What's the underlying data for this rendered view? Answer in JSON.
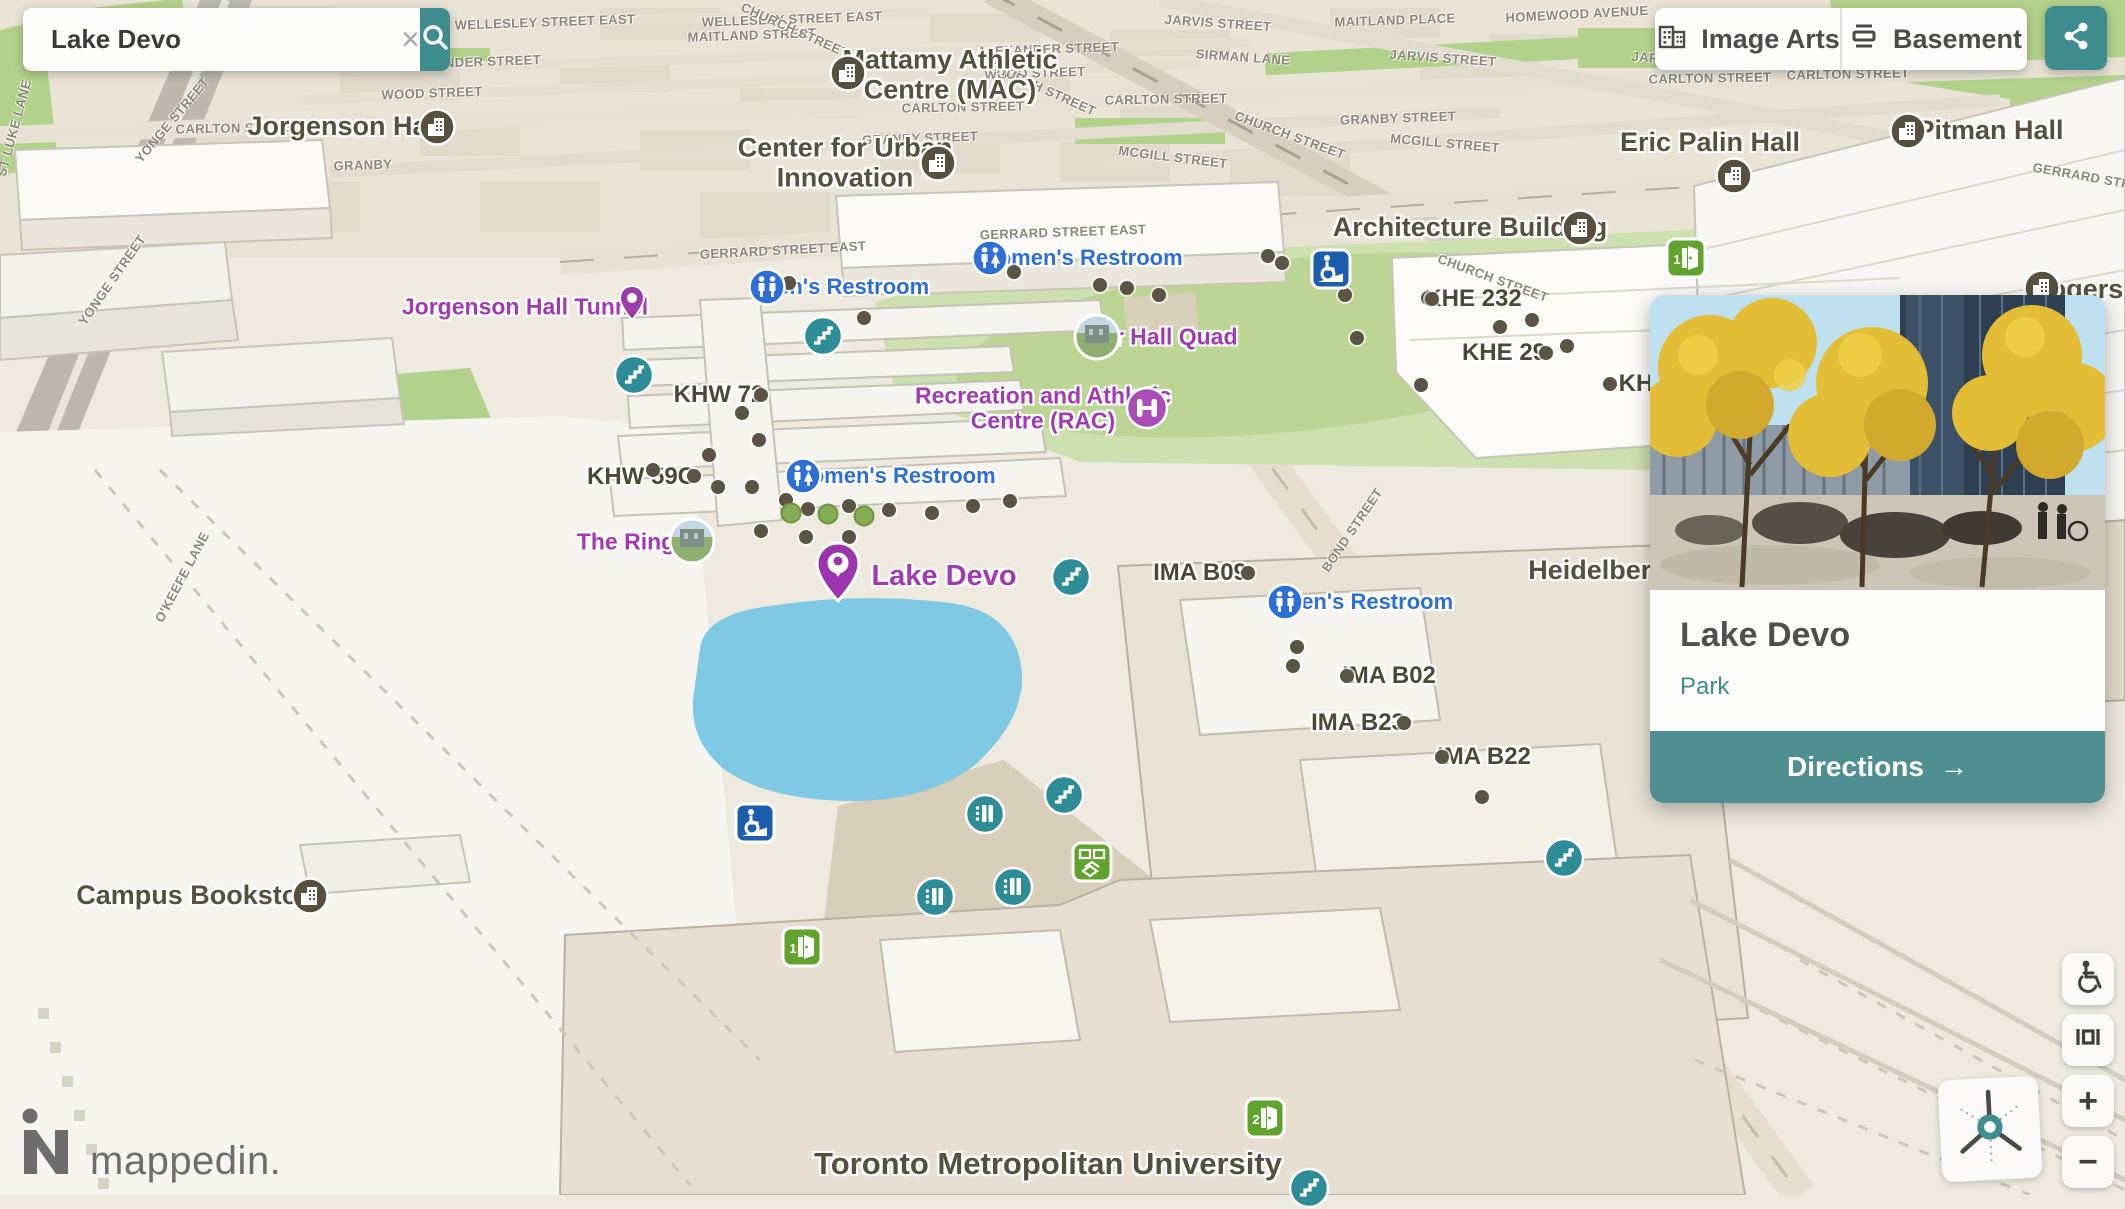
{
  "theme": {
    "accent_teal": "#3f8c8e",
    "purple": "#a23ab2",
    "label_blue": "#2e6fd6",
    "label_olive": "#57503e",
    "quad_green": "#c6dca6",
    "lake_blue": "#7fc9e4",
    "door_green": "#61a32d",
    "ramp_blue": "#1d5dad"
  },
  "search": {
    "value": "Lake Devo",
    "placeholder": "Search",
    "clear_icon": "×"
  },
  "toolbar": {
    "image_arts_label": "Image Arts",
    "basement_label": "Basement"
  },
  "card": {
    "title": "Lake Devo",
    "category": "Park",
    "directions_label": "Directions",
    "directions_arrow": "→"
  },
  "logo": {
    "text": "mappedin."
  },
  "controls": {
    "zoom_in": "+",
    "zoom_out": "−"
  },
  "map": {
    "streets": [
      {
        "t": "WELLESLEY STREET EAST",
        "x": 545,
        "y": 22,
        "r": -2
      },
      {
        "t": "WELLESLEY STREET EAST",
        "x": 792,
        "y": 19,
        "r": -2
      },
      {
        "t": "MAITLAND PLACE",
        "x": 1395,
        "y": 20,
        "r": -2
      },
      {
        "t": "HOMEWOOD AVENUE",
        "x": 1577,
        "y": 14,
        "r": -3
      },
      {
        "t": "JARVIS STREET",
        "x": 1218,
        "y": 23,
        "r": 4
      },
      {
        "t": "JARVIS STREET",
        "x": 1443,
        "y": 58,
        "r": 4
      },
      {
        "t": "JARVIS STREET",
        "x": 1685,
        "y": 60,
        "r": 4
      },
      {
        "t": "MAITLAND STREET",
        "x": 752,
        "y": 35,
        "r": -2
      },
      {
        "t": "ALEXANDER STREET",
        "x": 470,
        "y": 62,
        "r": -2
      },
      {
        "t": "ALEXANDER STREET",
        "x": 1048,
        "y": 49,
        "r": -2
      },
      {
        "t": "WOOD STREET",
        "x": 432,
        "y": 93,
        "r": -2
      },
      {
        "t": "WOOD STREET",
        "x": 1035,
        "y": 73,
        "r": -2
      },
      {
        "t": "SIRMAN LANE",
        "x": 1243,
        "y": 57,
        "r": 4
      },
      {
        "t": "CARLTON STREET",
        "x": 237,
        "y": 128,
        "r": -1
      },
      {
        "t": "CARLTON STREET",
        "x": 963,
        "y": 107,
        "r": -1
      },
      {
        "t": "CARLTON STREET",
        "x": 1166,
        "y": 99,
        "r": -1
      },
      {
        "t": "CARLTON STREET",
        "x": 1710,
        "y": 78,
        "r": -1
      },
      {
        "t": "CARLTON STREET",
        "x": 1848,
        "y": 74,
        "r": -1
      },
      {
        "t": "CHURCH STREET",
        "x": 795,
        "y": 30,
        "r": 24
      },
      {
        "t": "CHURCH STREET",
        "x": 1042,
        "y": 88,
        "r": 24
      },
      {
        "t": "CHURCH STREET",
        "x": 1290,
        "y": 135,
        "r": 20
      },
      {
        "t": "CHURCH STREET",
        "x": 1493,
        "y": 278,
        "r": 20
      },
      {
        "t": "MCGILL STREET",
        "x": 1173,
        "y": 157,
        "r": 7
      },
      {
        "t": "MCGILL STREET",
        "x": 1445,
        "y": 143,
        "r": 5
      },
      {
        "t": "GRANBY STREET",
        "x": 920,
        "y": 138,
        "r": -2
      },
      {
        "t": "GRANBY",
        "x": 363,
        "y": 165,
        "r": -2
      },
      {
        "t": "GRANBY STREET",
        "x": 1398,
        "y": 118,
        "r": -2
      },
      {
        "t": "GERRARD STREET EAST",
        "x": 783,
        "y": 250,
        "r": -3
      },
      {
        "t": "GERRARD STREET EAST",
        "x": 1063,
        "y": 232,
        "r": -2
      },
      {
        "t": "GERRARD STREET",
        "x": 2095,
        "y": 178,
        "r": 10
      },
      {
        "t": "BOND STREET",
        "x": 1352,
        "y": 530,
        "r": -56
      },
      {
        "t": "YONGE STREET",
        "x": 172,
        "y": 120,
        "r": -50
      },
      {
        "t": "YONGE STREET",
        "x": 112,
        "y": 280,
        "r": -55
      },
      {
        "t": "ST LUKE LANE",
        "x": 14,
        "y": 128,
        "r": -75
      },
      {
        "t": "O'KEEFE LANE",
        "x": 182,
        "y": 577,
        "r": -62
      }
    ],
    "buildings": [
      {
        "lines": [
          "Mattamy Athletic",
          "Centre (MAC)"
        ],
        "x": 950,
        "y": 75
      },
      {
        "lines": [
          "Center for Urban",
          "Innovation"
        ],
        "x": 845,
        "y": 163
      },
      {
        "lines": [
          "Jorgenson Hall"
        ],
        "x": 345,
        "y": 127
      },
      {
        "lines": [
          "Eric Palin Hall"
        ],
        "x": 1710,
        "y": 143
      },
      {
        "lines": [
          "Pitman Hall"
        ],
        "x": 1990,
        "y": 131
      },
      {
        "lines": [
          "Architecture Building"
        ],
        "x": 1470,
        "y": 228
      },
      {
        "lines": [
          "Campus Bookstore"
        ],
        "x": 200,
        "y": 896
      },
      {
        "lines": [
          "Rogers Communications"
        ],
        "x": 2190,
        "y": 290
      },
      {
        "lines": [
          "Heidelberg"
        ],
        "x": 1598,
        "y": 571
      },
      {
        "lines": [
          "Toronto Metropolitan University"
        ],
        "x": 1048,
        "y": 1164,
        "size": 31,
        "tmu": true
      }
    ],
    "rooms": [
      {
        "t": "KHW 72",
        "x": 719,
        "y": 395
      },
      {
        "t": "KHW 59C",
        "x": 641,
        "y": 477
      },
      {
        "t": "KHE 232",
        "x": 1473,
        "y": 299
      },
      {
        "t": "KHE 29",
        "x": 1504,
        "y": 353
      },
      {
        "t": "KH",
        "x": 1636,
        "y": 384
      },
      {
        "t": "IMA B09",
        "x": 1200,
        "y": 573
      },
      {
        "t": "IMA B02",
        "x": 1389,
        "y": 676
      },
      {
        "t": "IMA B23",
        "x": 1358,
        "y": 723
      },
      {
        "t": "IMA B22",
        "x": 1484,
        "y": 757
      }
    ],
    "purple_labels": [
      {
        "lines": [
          "Jorgenson Hall Tunnel"
        ],
        "x": 525,
        "y": 307
      },
      {
        "lines": [
          "The Ring"
        ],
        "x": 626,
        "y": 542
      },
      {
        "lines": [
          "Kerr Hall Quad"
        ],
        "x": 1157,
        "y": 337
      },
      {
        "lines": [
          "Recreation and Athletic",
          "Centre (RAC)"
        ],
        "x": 1043,
        "y": 409
      },
      {
        "lines": [
          "Lake Devo"
        ],
        "x": 944,
        "y": 577,
        "lake": true
      }
    ],
    "blue_labels": [
      {
        "t": "Women's Restroom",
        "x": 1080,
        "y": 258
      },
      {
        "t": "Men's Restroom",
        "x": 844,
        "y": 287
      },
      {
        "t": "Women's Restroom",
        "x": 893,
        "y": 476
      },
      {
        "t": "Men's Restroom",
        "x": 1368,
        "y": 602
      }
    ],
    "icons": [
      {
        "type": "building",
        "x": 848,
        "y": 73
      },
      {
        "type": "building",
        "x": 938,
        "y": 163
      },
      {
        "type": "building",
        "x": 437,
        "y": 127
      },
      {
        "type": "building",
        "x": 1734,
        "y": 176
      },
      {
        "type": "building",
        "x": 1908,
        "y": 131
      },
      {
        "type": "building",
        "x": 1580,
        "y": 228
      },
      {
        "type": "building",
        "x": 310,
        "y": 896
      },
      {
        "type": "building",
        "x": 2042,
        "y": 288
      },
      {
        "type": "restroom-women",
        "x": 990,
        "y": 258
      },
      {
        "type": "restroom-women",
        "x": 803,
        "y": 476
      },
      {
        "type": "restroom-men",
        "x": 767,
        "y": 287
      },
      {
        "type": "restroom-men",
        "x": 1285,
        "y": 602
      },
      {
        "type": "stairs",
        "x": 823,
        "y": 336
      },
      {
        "type": "stairs",
        "x": 634,
        "y": 375
      },
      {
        "type": "stairs",
        "x": 1071,
        "y": 577
      },
      {
        "type": "stairs",
        "x": 1064,
        "y": 795
      },
      {
        "type": "stairs",
        "x": 1564,
        "y": 858
      },
      {
        "type": "stairs",
        "x": 1309,
        "y": 1188
      },
      {
        "type": "elevator",
        "x": 985,
        "y": 814
      },
      {
        "type": "elevator",
        "x": 1013,
        "y": 887
      },
      {
        "type": "elevator",
        "x": 935,
        "y": 897
      },
      {
        "type": "rac",
        "x": 1147,
        "y": 408
      },
      {
        "type": "pin-small",
        "x": 632,
        "y": 303
      },
      {
        "type": "pin-large",
        "x": 838,
        "y": 572
      },
      {
        "type": "photo",
        "x": 1097,
        "y": 337
      },
      {
        "type": "photo",
        "x": 692,
        "y": 541
      },
      {
        "type": "door",
        "x": 802,
        "y": 947,
        "n": "1"
      },
      {
        "type": "door",
        "x": 1686,
        "y": 258,
        "n": "1"
      },
      {
        "type": "door",
        "x": 1265,
        "y": 1118,
        "n": "2"
      },
      {
        "type": "poi-special",
        "x": 1092,
        "y": 862
      },
      {
        "type": "ramp",
        "x": 755,
        "y": 823
      },
      {
        "type": "ramp",
        "x": 1331,
        "y": 269
      }
    ],
    "dots": [
      [
        789,
        283
      ],
      [
        864,
        318
      ],
      [
        1014,
        272
      ],
      [
        1100,
        285
      ],
      [
        1127,
        288
      ],
      [
        1159,
        295
      ],
      [
        1268,
        256
      ],
      [
        1282,
        263
      ],
      [
        1345,
        295
      ],
      [
        1357,
        338
      ],
      [
        1428,
        298
      ],
      [
        1500,
        327
      ],
      [
        1567,
        346
      ],
      [
        1421,
        385
      ],
      [
        742,
        413
      ],
      [
        759,
        440
      ],
      [
        709,
        455
      ],
      [
        653,
        470
      ],
      [
        718,
        487
      ],
      [
        752,
        487
      ],
      [
        786,
        500
      ],
      [
        808,
        509
      ],
      [
        849,
        506
      ],
      [
        889,
        510
      ],
      [
        932,
        513
      ],
      [
        973,
        506
      ],
      [
        1010,
        501
      ],
      [
        806,
        537
      ],
      [
        849,
        537
      ],
      [
        761,
        531
      ],
      [
        694,
        476
      ],
      [
        761,
        395
      ],
      [
        1432,
        299
      ],
      [
        1546,
        353
      ],
      [
        1610,
        384
      ],
      [
        1248,
        573
      ],
      [
        1297,
        647
      ],
      [
        1293,
        666
      ],
      [
        1347,
        676
      ],
      [
        1404,
        723
      ],
      [
        1442,
        757
      ],
      [
        1482,
        797
      ],
      [
        1532,
        320
      ]
    ],
    "trees": [
      [
        791,
        513
      ],
      [
        828,
        514
      ],
      [
        864,
        516
      ]
    ]
  }
}
